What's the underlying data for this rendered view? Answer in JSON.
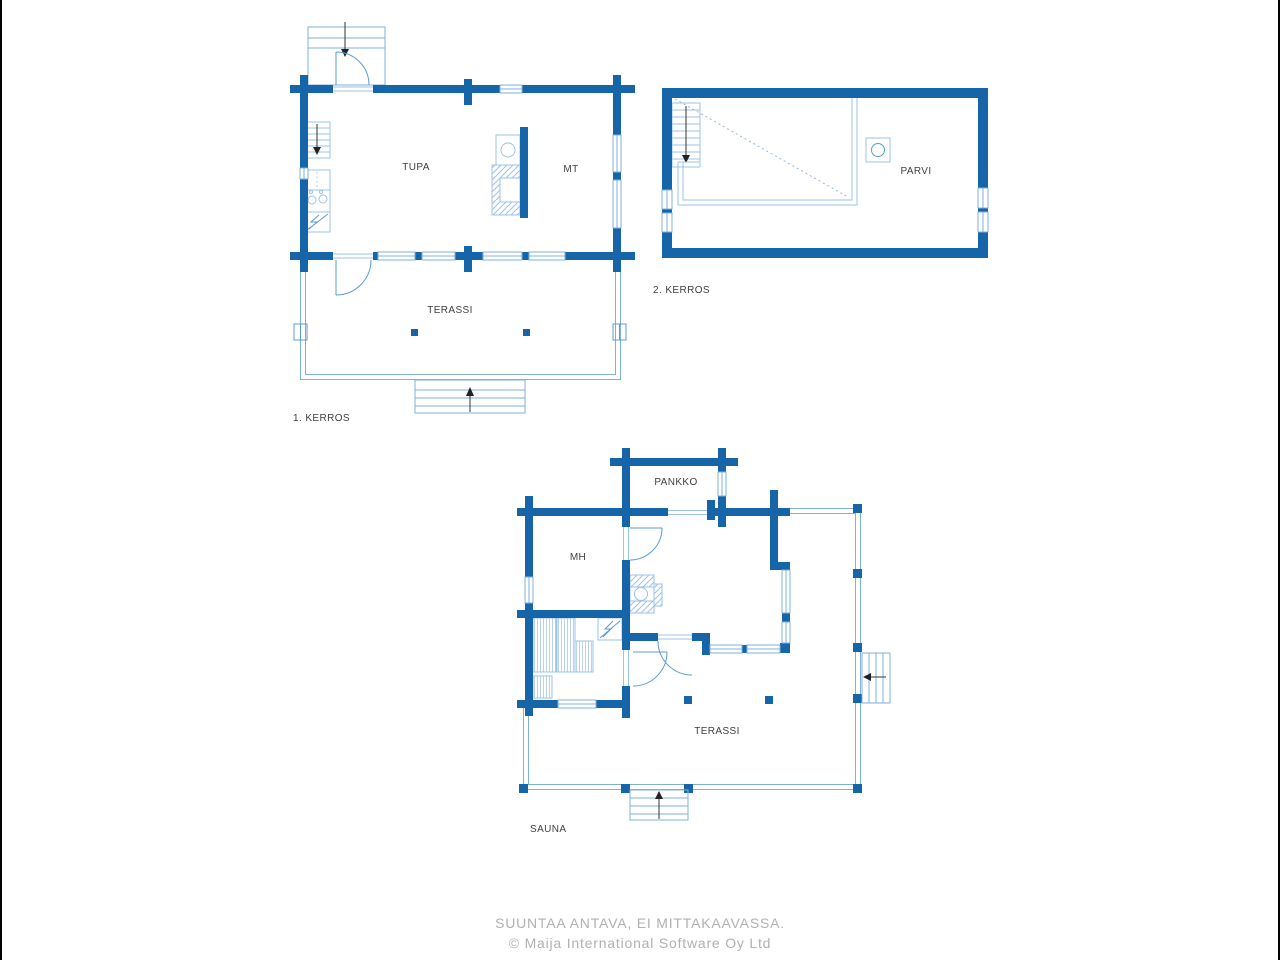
{
  "colors": {
    "wall_blue": "#1565a8",
    "fixture_light_blue": "#9cc3e8",
    "outline_blue": "#7fb0dc",
    "door_arc_blue": "#5b9bd5",
    "label_gray": "#3f3f3f",
    "footer_gray": "#b2b0b2"
  },
  "plans": {
    "floor1": {
      "name_label": "1. KERROS",
      "rooms": {
        "tupa": "TUPA",
        "mt": "MT",
        "terassi": "TERASSI"
      }
    },
    "floor2": {
      "name_label": "2. KERROS",
      "rooms": {
        "parvi": "PARVI"
      }
    },
    "sauna": {
      "name_label": "SAUNA",
      "rooms": {
        "pankko": "PANKKO",
        "mh": "MH",
        "terassi": "TERASSI"
      }
    }
  },
  "footer": {
    "line1": "SUUNTAA ANTAVA, EI MITTAKAAVASSA.",
    "line2": "© Maija International Software Oy Ltd"
  }
}
